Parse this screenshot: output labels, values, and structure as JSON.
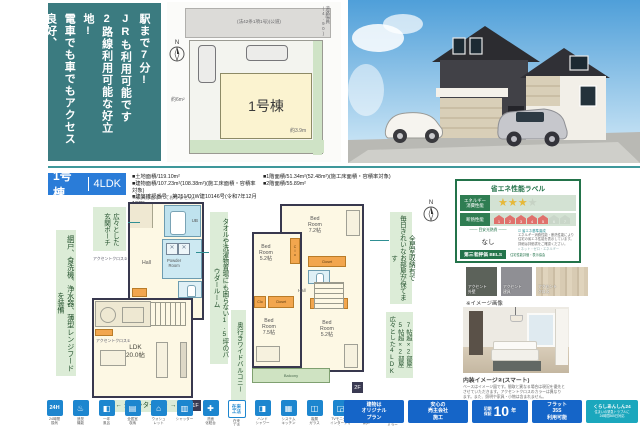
{
  "intro": {
    "text": "駅まで7分!\nJRも利用可能です\n2路線利用可能な好立地!\n電車でも車でもアクセス良好、\n徒歩や自転車でも快適な\n周辺環境が整った1区画"
  },
  "site": {
    "road_label": "(法42条1項1号)(公道)",
    "road_width": "道路幅員(4.90)",
    "north": "N",
    "unit": "1号棟",
    "car_area": "約6m²",
    "setback": "約3.9m"
  },
  "info": {
    "unit": "1号棟",
    "layout": "4LDK",
    "col1": [
      "■土地面積/119.10m²",
      "■建物面積/107.23m²(108.38m²)(施工床面積・容積率対象)",
      "■建築確認番号　第251/D1W建10146号(令和7年12月13日)"
    ],
    "col2": [
      "■1階面積/51.34m²(52.48m²)(施工床面積・容積率対象)",
      "■2階面積/55.89m²"
    ],
    "note": "※家具は含まれておりません。"
  },
  "callouts": {
    "equip": "網戸、食洗機、浄水器、薄型レンジフードを装備",
    "porch": "広々とした\n玄関ポーチ",
    "towel": "タオルや洗濯物置場にも困らない1.5坪のパウダールーム",
    "shutter": "← シャッターあり →",
    "balcony": "奥行きワイドバルコニー",
    "storage": "全居室収納有で\n毎日きれいなお部屋が保てます",
    "rooms": "7帖超×2部屋\n5帖超×2部屋\n広々とした4LDK"
  },
  "plan1f": {
    "ub": "UB",
    "powder": "Powder\nRoom",
    "hall": "Hall",
    "ldk": "LDK\n20.0帖",
    "accent1": "アクセントクロス①",
    "accent2": "アクセントクロス②",
    "tag": "1F"
  },
  "plan2f": {
    "br1": "Bed\nRoom\n7.2帖",
    "br2": "Bed\nRoom\n5.2帖",
    "br3": "Bed\nRoom\n7.5帖",
    "br4": "Bed\nRoom\n5.2帖",
    "closet": "Closet",
    "clo": "Clo",
    "hall": "Hall",
    "wc": "WC",
    "balcony": "Balcony",
    "tag": "2F"
  },
  "energy": {
    "title": "省エネ性能ラベル",
    "row1_label": "エネルギー\n消費性能",
    "row2_label": "断熱性能",
    "stars_on": "★★★",
    "star_off": "★",
    "levels": [
      "1",
      "2",
      "3",
      "4",
      "5",
      "6",
      "7"
    ],
    "cost_label": "目安光熱費",
    "cost_value": "なし",
    "check1": "☑ 省エネ基準達成",
    "note": "エネルギー消費性能・断熱性能により\n住宅の省エネ性能を表示しています。\n詳細は評価書をご確認ください。",
    "check2": "□ ネット・ゼロ・エネルギー",
    "badge": "第三者評価 BELS",
    "footer_note": "住宅性能評価・表示協会"
  },
  "swatches": {
    "items": [
      "アクセント\n外壁",
      "アクセント\n建具",
      "アクセント\nクロス"
    ],
    "note": "※イメージ画像"
  },
  "interior": {
    "title": "内装イメージ②(スマート)",
    "note": "ベースはイメージ図です。間取と異なる場合は現況を優先と\nさせていただきます。アクセントクロスのカラーは異なり\nます。また、照明や家具・小物は含まれません。"
  },
  "bottom": {
    "icons": [
      {
        "glyph": "24H",
        "label": "24時間\n換気"
      },
      {
        "glyph": "♨",
        "label": "追焚\n機能"
      },
      {
        "glyph": "◧",
        "label": "一坪\n風呂"
      },
      {
        "glyph": "▤",
        "label": "全居室\n収納"
      },
      {
        "glyph": "⌂",
        "label": "ウォシュ\nレット"
      },
      {
        "glyph": "▥",
        "label": "シャッター"
      },
      {
        "glyph": "✚",
        "label": "洗面\n化粧台"
      },
      {
        "glyph": "在来\n工法",
        "label": "在来\n工法"
      },
      {
        "glyph": "◨",
        "label": "ハンド\nシャワー"
      },
      {
        "glyph": "▦",
        "label": "システム\nキッチン"
      },
      {
        "glyph": "◫",
        "label": "複層\nガラス"
      },
      {
        "glyph": "◲",
        "label": "TVモニター\nインターフォン"
      },
      {
        "glyph": "▯",
        "label": "全居室\n網戸"
      },
      {
        "glyph": "◻",
        "label": "玄関\nミラー"
      }
    ],
    "badges": {
      "b1": "建物は\nオリジナル\nプラン",
      "b2": "安心の\n売主会社\n施工",
      "b3_small": "初期\n保証",
      "b3_big": "10",
      "b3_unit": "年",
      "b4": "フラット\n35S\n利用可能",
      "b5_title": "くらしあんしん24",
      "b5_sub": "住まいの緊急トラブルに\n24時間365日対応"
    }
  }
}
